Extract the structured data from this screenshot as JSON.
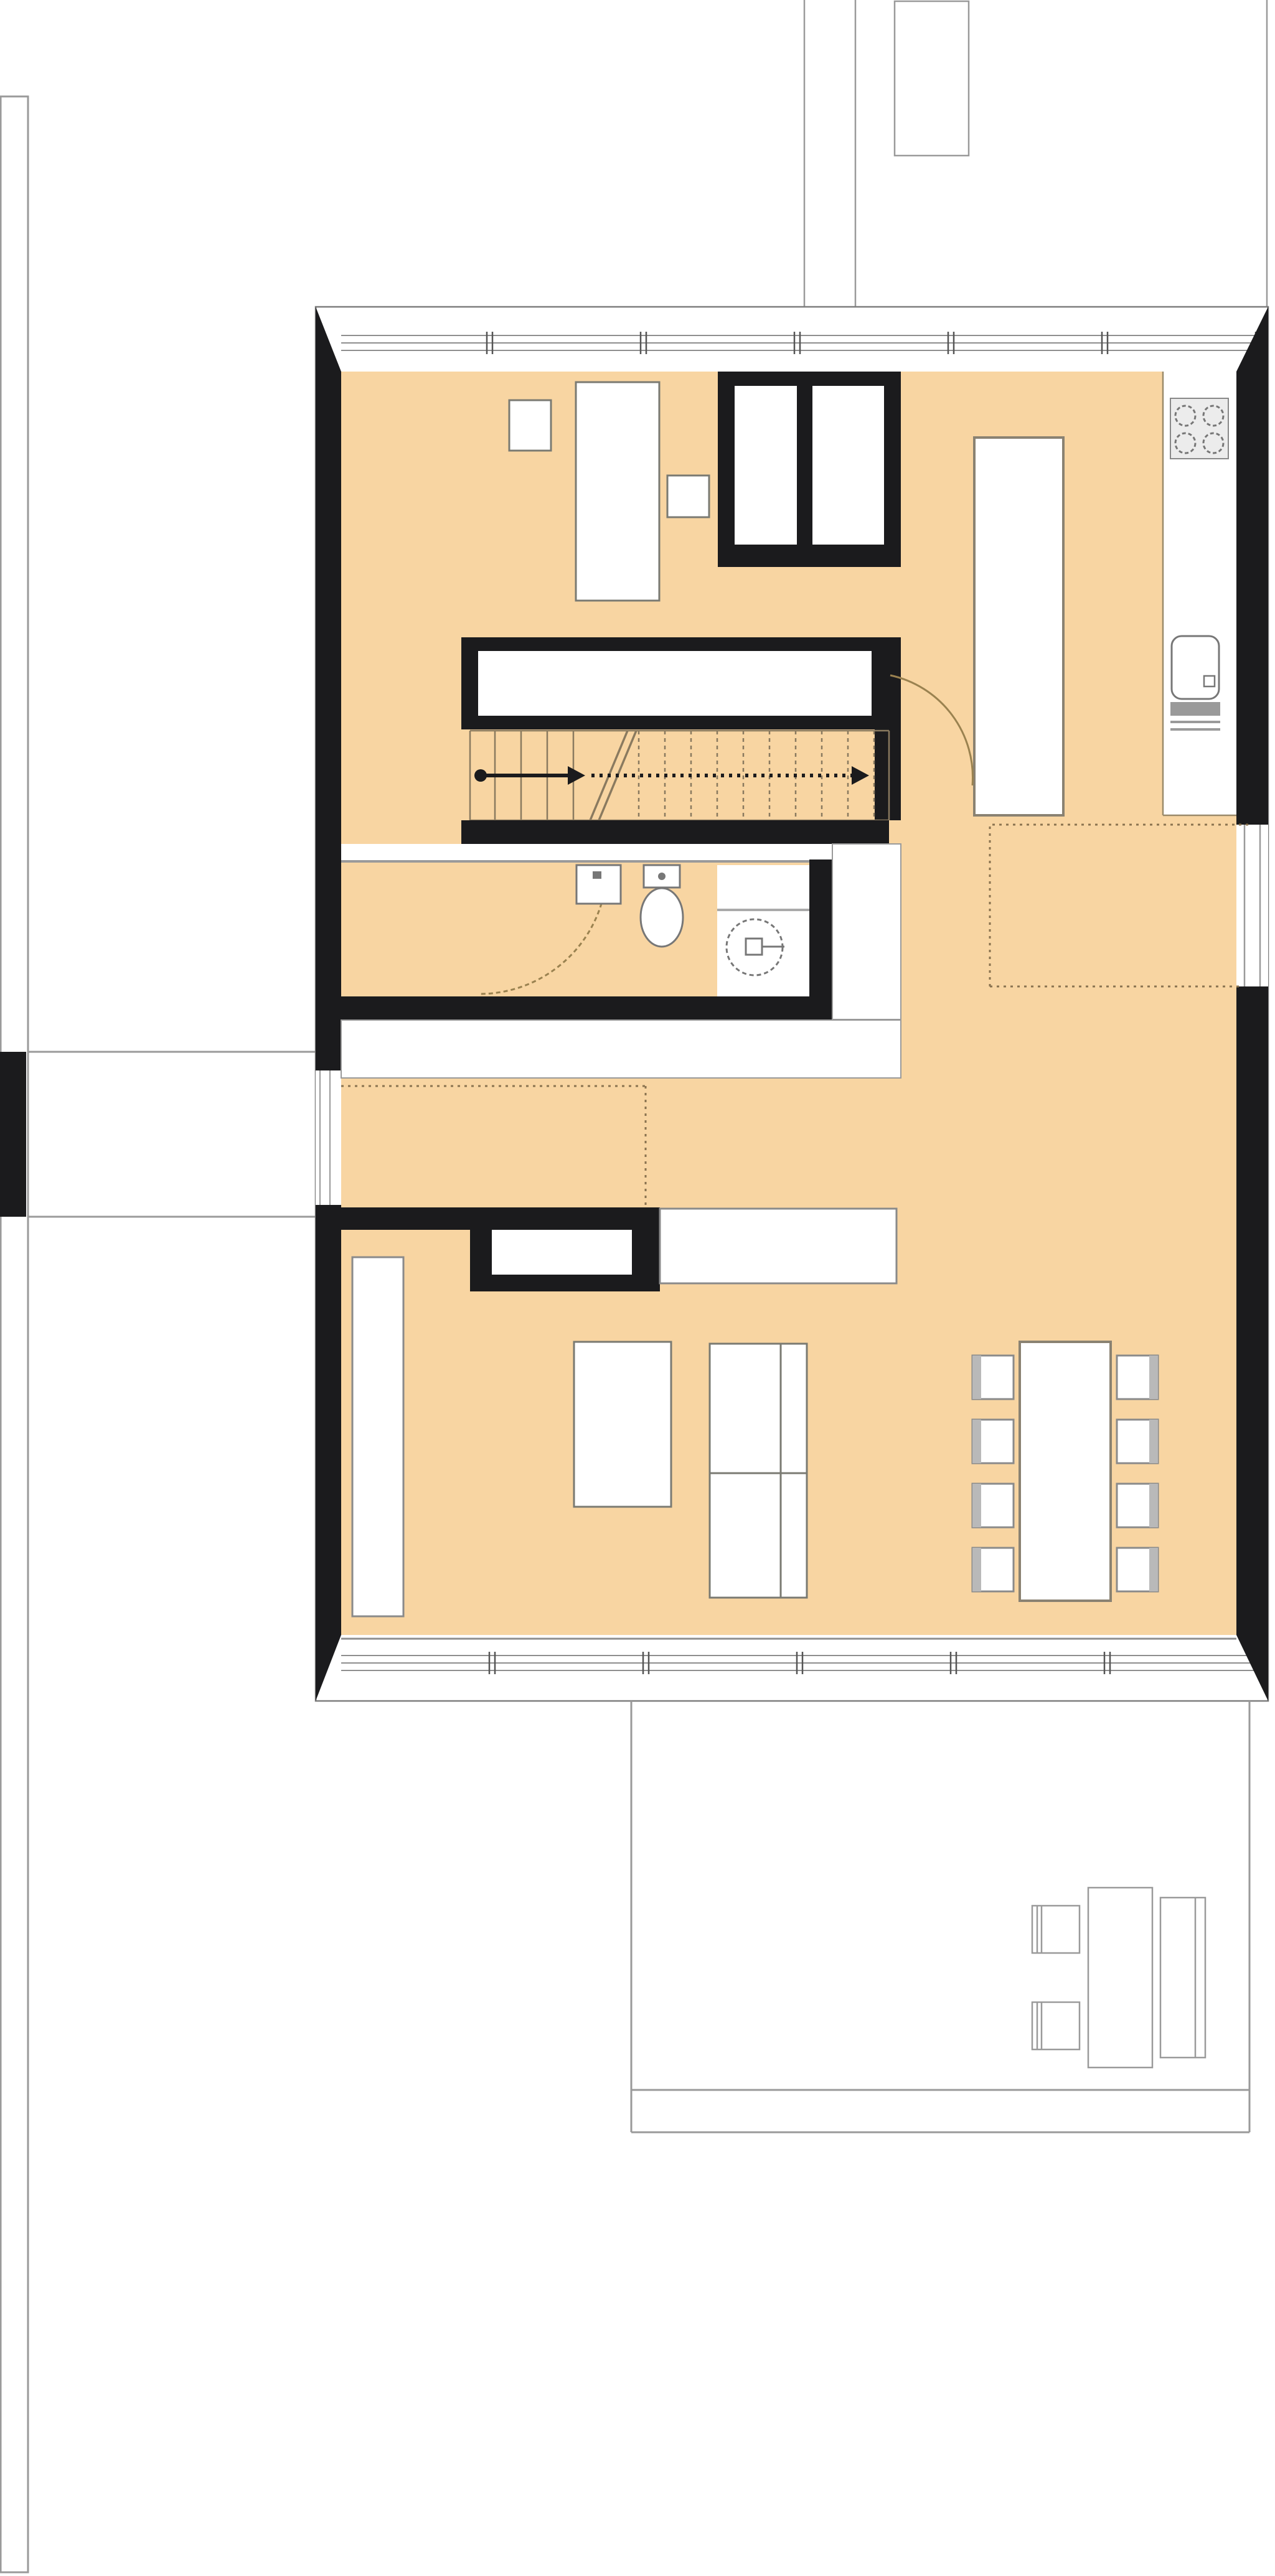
{
  "document": {
    "type": "architectural-floor-plan",
    "view": "top-down plan",
    "visible_text": "",
    "floor_fill_visible": true
  },
  "colors": {
    "background": "#ffffff",
    "floor": "#f8d5a2",
    "wall": "#1b1b1d",
    "outline": "#7d7d7d",
    "thin": "#8e8e8e",
    "site": "#9a9a9a",
    "dotted": "#8a7350",
    "door": "#9a8250",
    "stair": "#8a7a5f",
    "fixture": "#777777",
    "furniture_edge": "#7a7a72",
    "shadow": "#b9b9b9",
    "stove_bg": "#ececec",
    "drain": "#9a9a9a",
    "white": "#ffffff"
  },
  "inventory": {
    "stove_burners": 4,
    "kitchen_sink": 1,
    "kitchen_drainboard": 1,
    "kitchen_island": 1,
    "dining_table": 1,
    "dining_chairs": 8,
    "beds": 2,
    "nightstands": 2,
    "built_in_closets": 4,
    "toilet": 1,
    "washbasin": 1,
    "washing_machine": 1,
    "stair_flight_with_arrow": 1,
    "door_swing_arcs": 2,
    "terrace_chairs": 2,
    "terrace_tables": 2,
    "entrance_porch": 1,
    "site_strip": 1,
    "upper_court_outline": 1,
    "window_mullion_ticks_top": 6,
    "window_mullion_ticks_bottom": 5
  }
}
